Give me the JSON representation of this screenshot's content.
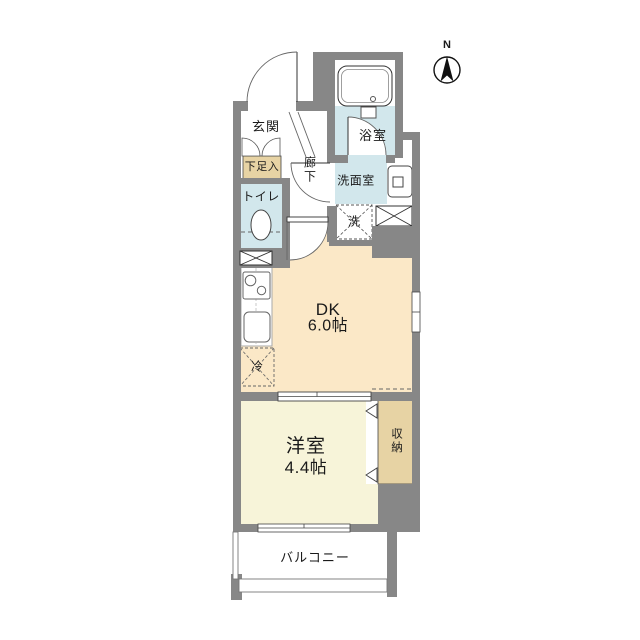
{
  "compass": {
    "label": "N"
  },
  "rooms": {
    "entrance": {
      "label": "玄関"
    },
    "shoe_cabinet": {
      "label": "下足入"
    },
    "toilet": {
      "label": "トイレ"
    },
    "hallway": {
      "label": "廊下"
    },
    "bathroom": {
      "label": "浴室"
    },
    "washroom": {
      "label": "洗面室"
    },
    "washer": {
      "label": "洗"
    },
    "dining_kitchen": {
      "label": "DK",
      "size": "6.0帖"
    },
    "refrigerator": {
      "label": "冷"
    },
    "western_room": {
      "label": "洋室",
      "size": "4.4帖"
    },
    "closet": {
      "label": "収納"
    },
    "balcony": {
      "label": "バルコニー"
    }
  },
  "colors": {
    "wall": "#878787",
    "wet_room_floor": "#d2e7ec",
    "storage": "#e7d3a4",
    "dk_floor": "#fbe8c7",
    "bedroom_floor": "#f7f4d9",
    "line": "#333333",
    "background": "#ffffff"
  }
}
